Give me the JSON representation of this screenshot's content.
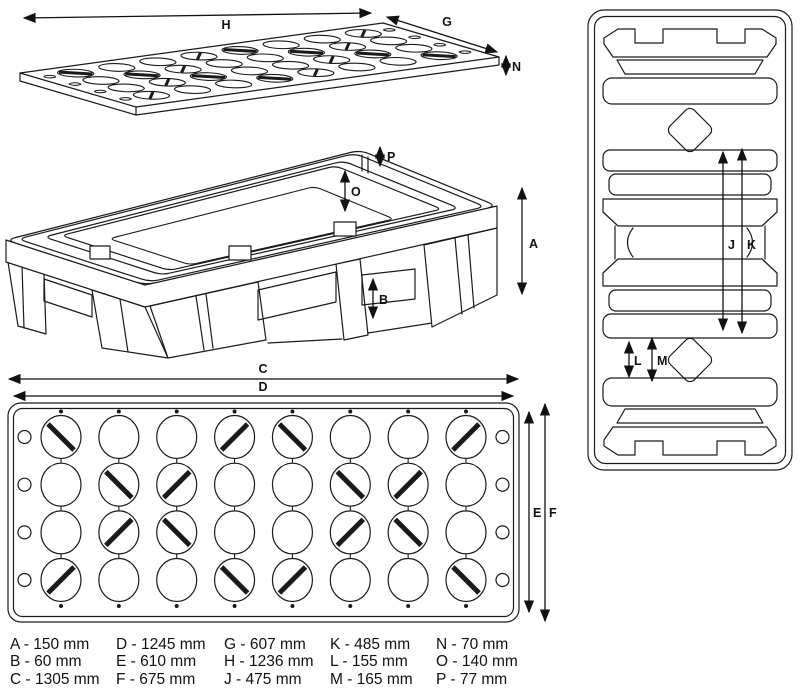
{
  "dimension_labels": {
    "A": "A",
    "B": "B",
    "C": "C",
    "D": "D",
    "E": "E",
    "F": "F",
    "G": "G",
    "H": "H",
    "J": "J",
    "K": "K",
    "L": "L",
    "M": "M",
    "N": "N",
    "O": "O",
    "P": "P"
  },
  "dimensions_mm": {
    "A": 150,
    "B": 60,
    "C": 1305,
    "D": 1245,
    "E": 610,
    "F": 675,
    "G": 607,
    "H": 1236,
    "J": 475,
    "K": 485,
    "L": 155,
    "M": 165,
    "N": 70,
    "O": 140,
    "P": 77
  },
  "legend": {
    "columns": [
      {
        "items": [
          "A - 150 mm",
          "B - 60 mm",
          "C - 1305 mm"
        ]
      },
      {
        "items": [
          "D - 1245 mm",
          "E - 610 mm",
          "F - 675 mm"
        ]
      },
      {
        "items": [
          "G - 607 mm",
          "H - 1236 mm",
          "J - 475 mm"
        ]
      },
      {
        "items": [
          "K - 485 mm",
          "L - 155 mm",
          "M - 165 mm"
        ]
      },
      {
        "items": [
          "N - 70 mm",
          "O - 140 mm",
          "P - 77 mm"
        ]
      }
    ]
  },
  "hole_grid": {
    "cols": 8,
    "rows": 4,
    "slash_pattern": [
      [
        "\\",
        "",
        "",
        "/",
        "\\",
        "",
        "",
        "/"
      ],
      [
        "",
        "\\",
        "/",
        "",
        "",
        "\\",
        "/",
        ""
      ],
      [
        "",
        "/",
        "\\",
        "",
        "",
        "/",
        "\\",
        ""
      ],
      [
        "/",
        "",
        "",
        "\\",
        "/",
        "",
        "",
        "\\"
      ]
    ]
  },
  "line_color": "#1a1a1a"
}
